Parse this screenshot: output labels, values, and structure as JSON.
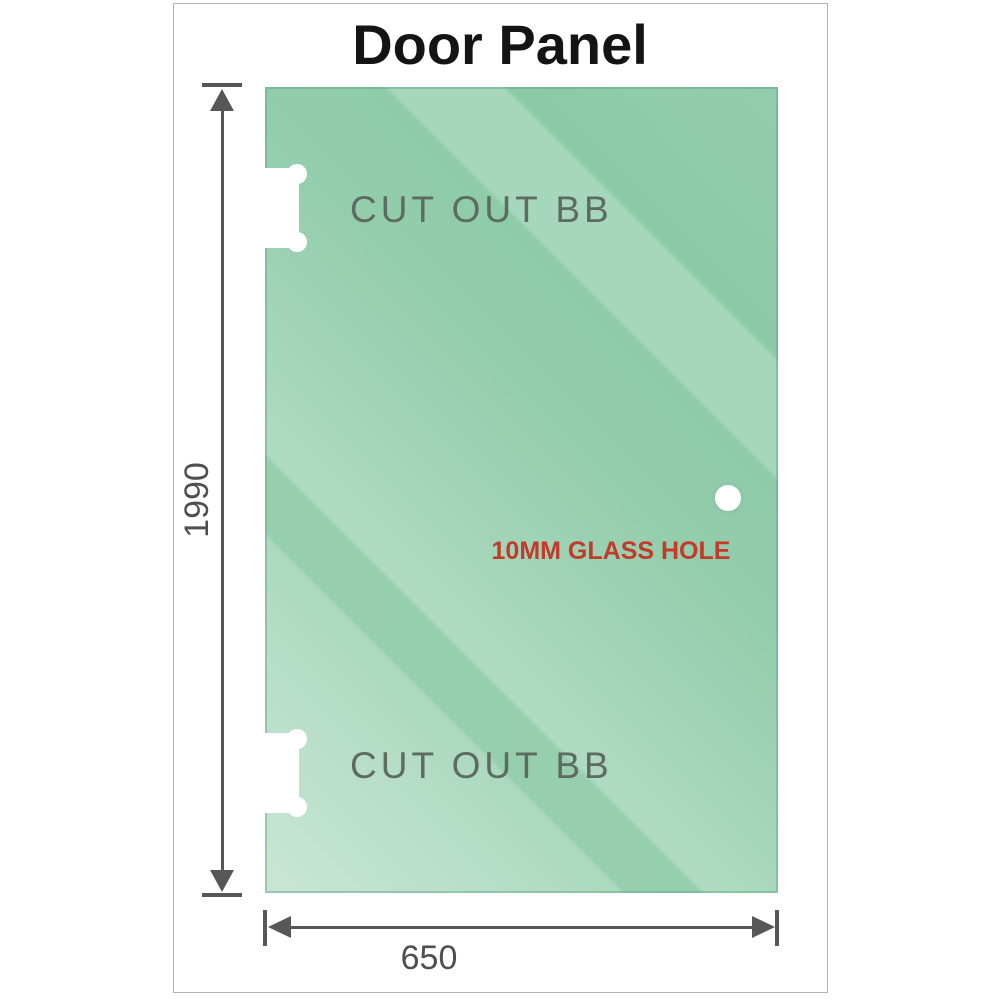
{
  "title": "Door Panel",
  "panel": {
    "description": "glass door panel with hinge cutouts and handle hole",
    "cutouts": [
      {
        "label": "CUT OUT BB"
      },
      {
        "label": "CUT OUT BB"
      }
    ],
    "hole": {
      "label": "10MM GLASS HOLE"
    }
  },
  "dimensions": {
    "height_mm": "1990",
    "width_mm": "650"
  },
  "colors": {
    "glass_base": "#87c8a3",
    "glass_highlight": "#cfe9d6",
    "dimension_lines": "#575757",
    "dimension_text": "#4f4f4f",
    "cutout_label_text": "#5d6b62",
    "hole_label_text": "#c33a2a",
    "frame_border": "#b3b3b3",
    "title_text": "#141414"
  }
}
